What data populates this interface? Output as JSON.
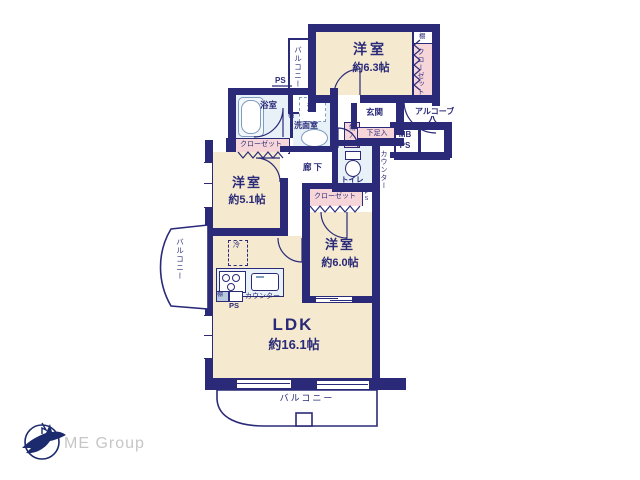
{
  "plan": {
    "rooms": {
      "bedroom1": {
        "name": "洋室",
        "size": "約6.3帖"
      },
      "bedroom2": {
        "name": "洋室",
        "size": "約5.1帖"
      },
      "bedroom3": {
        "name": "洋室",
        "size": "約6.0帖"
      },
      "ldk": {
        "name": "LDK",
        "size": "約16.1帖"
      }
    },
    "labels": {
      "balcony_top": "バルコニー",
      "balcony_left": "バルコニー",
      "balcony_bottom": "バルコニー",
      "closet_bedroom1": "クローゼット",
      "closet_bedroom2": "クローゼット",
      "closet_bedroom3": "クローゼット",
      "genkan": "玄関",
      "alcove": "アルコーブ",
      "shoe_box": "下足入",
      "storage": "物入",
      "toilet": "トイレ",
      "bath": "浴室",
      "washroom": "洗面室",
      "washer": "洗",
      "shelf_bedroom1": "棚",
      "shelf_washroom": "棚",
      "shelf_kitchen": "棚",
      "hallway": "廊下",
      "fridge": "冷",
      "counter_kitchen": "カウンター",
      "counter_right": "カウンター",
      "ps_top": "PS",
      "ps_closet": "PS",
      "ps_kitchen": "PS",
      "mb_line1": "MB",
      "mb_line2": "PS"
    },
    "colors": {
      "wall": "#2a2a78",
      "room_fill": "#f5ead0",
      "closet_fill": "#f7d6d9",
      "wet_fill": "#e9f1f8",
      "text": "#2a2a78"
    }
  },
  "footer": {
    "logo_text": "ME Group"
  }
}
